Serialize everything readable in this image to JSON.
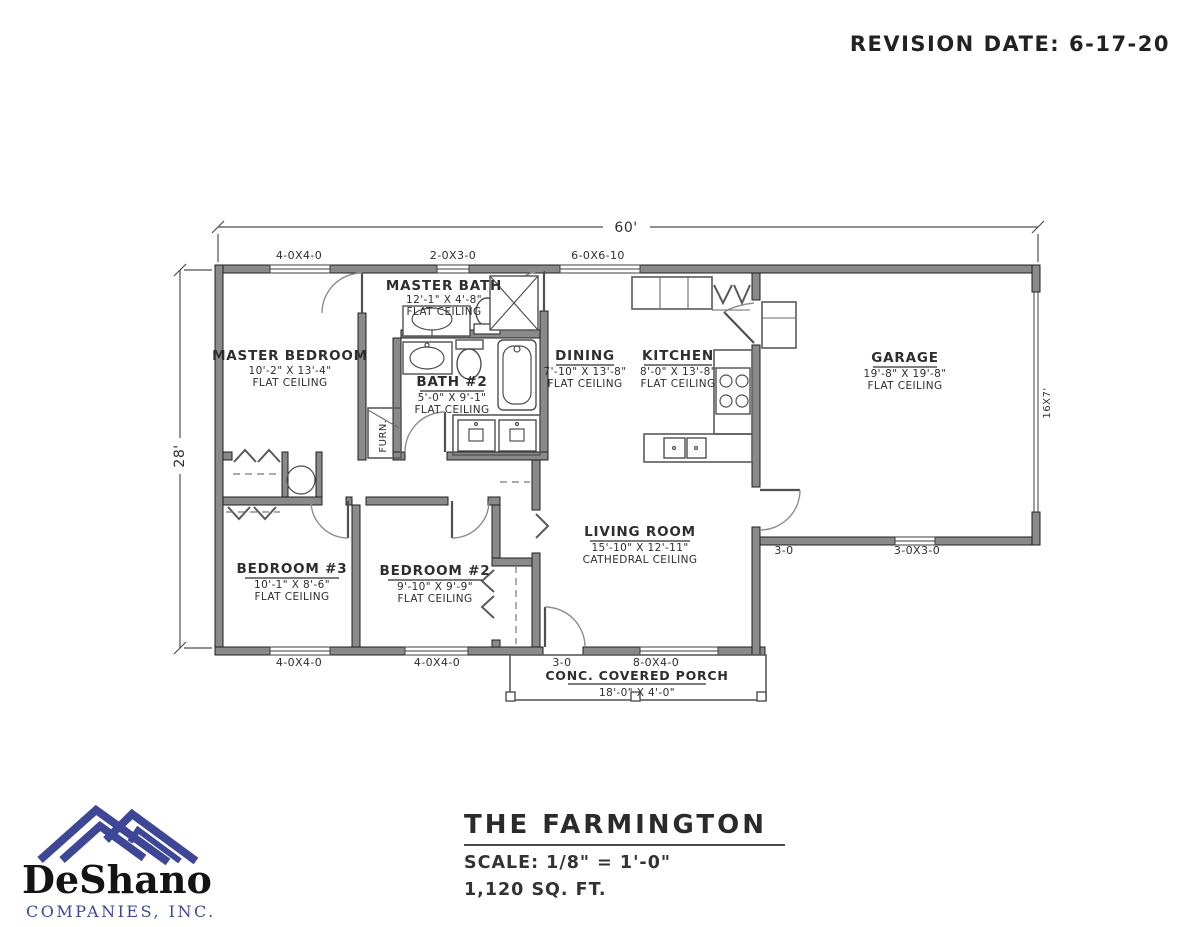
{
  "revision": "REVISION DATE: 6-17-20",
  "dims": {
    "width": "60'",
    "height": "28'",
    "garage_door": "16X7'"
  },
  "openings": {
    "top": [
      "4-0X4-0",
      "2-0X3-0",
      "6-0X6-10"
    ],
    "bottom": [
      "4-0X4-0",
      "4-0X4-0",
      "3-0",
      "8-0X4-0"
    ],
    "garage_door_label": "3-0",
    "garage_window": "3-0X3-0"
  },
  "rooms": {
    "master_bath": {
      "name": "MASTER BATH",
      "size": "12'-1\" X 4'-8\"",
      "ceiling": "FLAT CEILING"
    },
    "master_bedroom": {
      "name": "MASTER BEDROOM",
      "size": "10'-2\" X 13'-4\"",
      "ceiling": "FLAT CEILING"
    },
    "bath2": {
      "name": "BATH #2",
      "size": "5'-0\" X 9'-1\"",
      "ceiling": "FLAT CEILING"
    },
    "dining": {
      "name": "DINING",
      "size": "7'-10\" X 13'-8\"",
      "ceiling": "FLAT CEILING"
    },
    "kitchen": {
      "name": "KITCHEN",
      "size": "8'-0\" X 13'-8\"",
      "ceiling": "FLAT CEILING"
    },
    "garage": {
      "name": "GARAGE",
      "size": "19'-8\" X 19'-8\"",
      "ceiling": "FLAT CEILING"
    },
    "living": {
      "name": "LIVING ROOM",
      "size": "15'-10\" X 12'-11\"",
      "ceiling": "CATHEDRAL CEILING"
    },
    "bedroom3": {
      "name": "BEDROOM #3",
      "size": "10'-1\" X 8'-6\"",
      "ceiling": "FLAT CEILING"
    },
    "bedroom2": {
      "name": "BEDROOM #2",
      "size": "9'-10\" X 9'-9\"",
      "ceiling": "FLAT CEILING"
    },
    "furnace": {
      "name": "FURN."
    }
  },
  "porch": {
    "name": "CONC. COVERED PORCH",
    "size": "18'-0\" X 4'-0\""
  },
  "title_block": {
    "title": "THE FARMINGTON",
    "scale": "SCALE: 1/8\" = 1'-0\"",
    "area": "1,120 SQ. FT."
  },
  "logo": {
    "name": "DeShano",
    "subtitle": "COMPANIES, INC."
  },
  "colors": {
    "wall_fill": "#8a8a8a",
    "brand_blue": "#3e4796",
    "line": "#4f4f4f"
  }
}
